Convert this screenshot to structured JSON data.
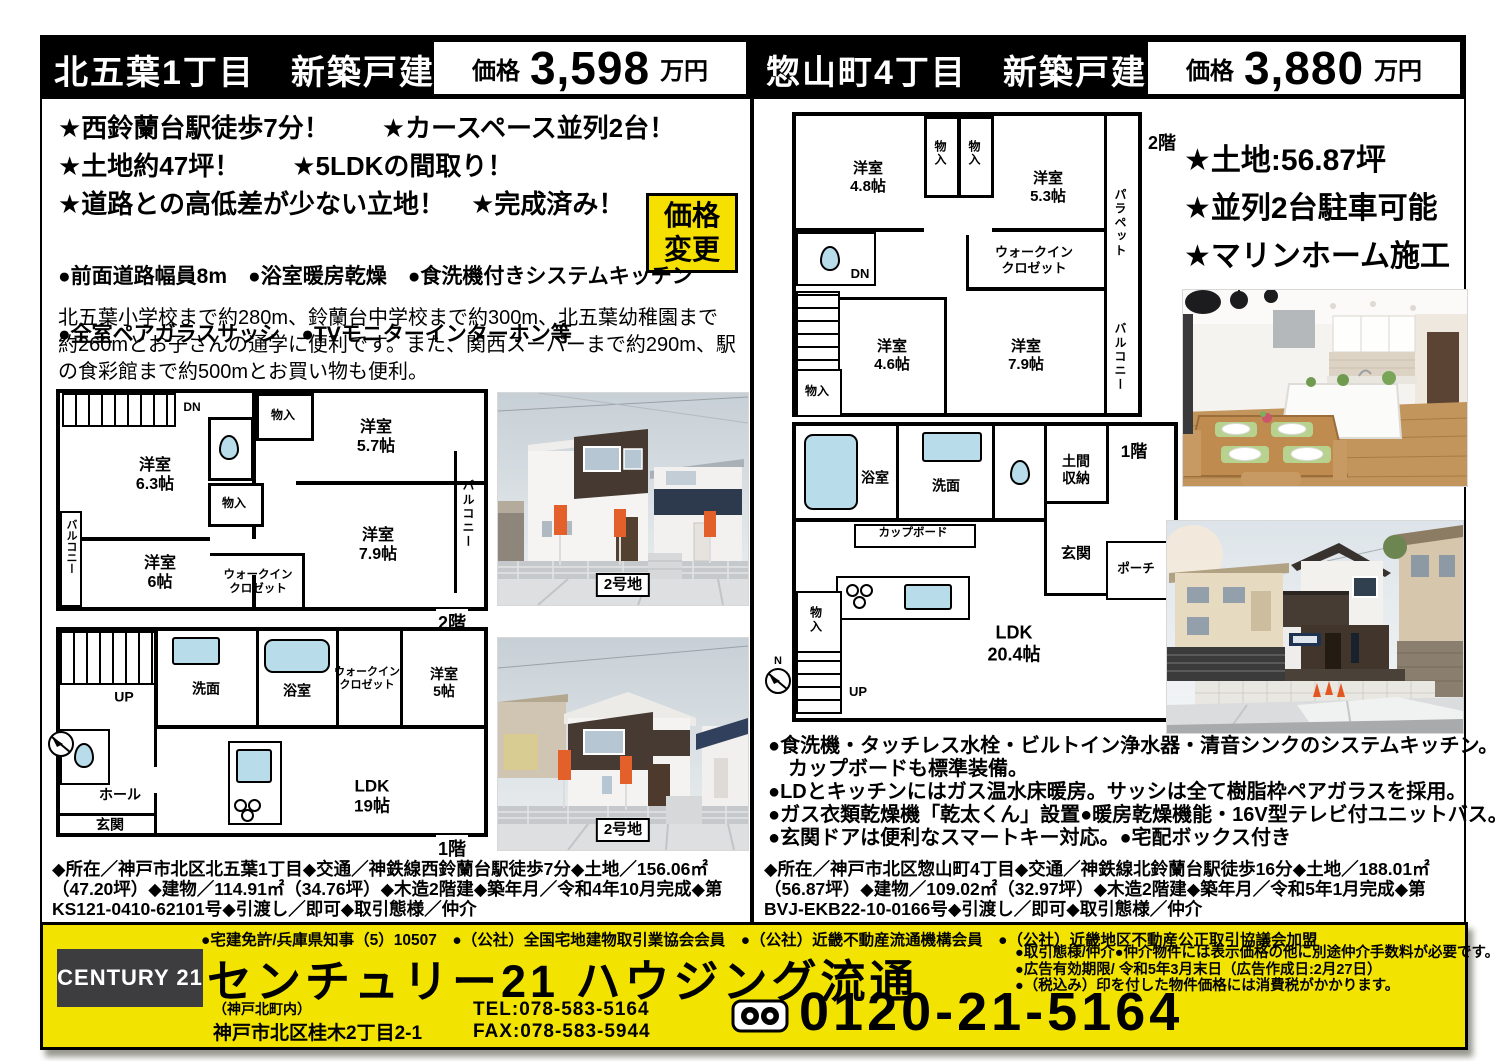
{
  "left": {
    "title": "北五葉1丁目　新築戸建",
    "price": {
      "label": "価格",
      "value": "3,598",
      "unit": "万円"
    },
    "features": [
      "★西鈴蘭台駅徒歩7分！　　★カースペース並列2台！",
      "★土地約47坪！　　★5LDKの間取り！",
      "★道路との高低差が少ない立地！　★完成済み！"
    ],
    "badge": "価格\n変更",
    "equipment": [
      "●前面道路幅員8m　●浴室暖房乾燥　●食洗機付きシステムキッチン",
      "●全室ペアガラスサッシ　●TVモニターインターホン等"
    ],
    "description": "北五葉小学校まで約280m、鈴蘭台中学校まで約300m、北五葉幼稚園まで約260mとお子さんの通学に便利です。また、関西スーパーまで約290m、駅の食彩館まで約500mとお買い物も便利。",
    "floor2": {
      "label": "2階",
      "dn": "DN",
      "room_a": "洋室\n6.3帖",
      "room_b": "洋室\n5.7帖",
      "room_c": "洋室\n6帖",
      "room_d": "洋室\n7.9帖",
      "closet_a": "物入",
      "closet_b": "物入",
      "wic": "ウォークイン\nクロゼット",
      "balcony_left": "バルコニー",
      "balcony_right": "バルコニー"
    },
    "floor1": {
      "label": "1階",
      "up": "UP",
      "washroom": "洗面",
      "bath": "浴室",
      "wic": "ウォークイン\nクロゼット",
      "room": "洋室\n5帖",
      "hall": "ホール",
      "entrance": "玄関",
      "ldk": "LDK\n19帖"
    },
    "photo1_label": "2号地",
    "photo2_label": "2号地",
    "details": "◆所在／神戸市北区北五葉1丁目◆交通／神鉄線西鈴蘭台駅徒歩7分◆土地／156.06㎡（47.20坪）◆建物／114.91㎡（34.76坪）◆木造2階建◆築年月／令和4年10月完成◆第KS121-0410-62101号◆引渡し／即可◆取引態様／仲介"
  },
  "right": {
    "title": "惣山町4丁目　新築戸建",
    "price": {
      "label": "価格",
      "value": "3,880",
      "unit": "万円"
    },
    "features": [
      "★土地:56.87坪",
      "★並列2台駐車可能",
      "★マリンホーム施工"
    ],
    "floor2": {
      "label": "2階",
      "dn": "DN",
      "room_a": "洋室\n4.8帖",
      "room_b": "洋室\n5.3帖",
      "room_c": "洋室\n4.6帖",
      "room_d": "洋室\n7.9帖",
      "closet_a": "物入",
      "closet_b": "物入",
      "closet_c": "物入",
      "wic": "ウォークイン\nクロゼット",
      "parapet": "パラペット",
      "balcony": "バルコニー"
    },
    "floor1": {
      "label": "1階",
      "up": "UP",
      "bath": "浴室",
      "washroom": "洗面",
      "doma": "土間\n収納",
      "cupboard": "カップボード",
      "entrance": "玄関",
      "porch": "ポーチ",
      "closet": "物\n入",
      "ldk": "LDK\n20.4帖",
      "north": "N"
    },
    "bullets": [
      "●食洗機・タッチレス水栓・ビルトイン浄水器・清音シンクのシステムキッチン。",
      "　カップボードも標準装備。",
      "●LDとキッチンにはガス温水床暖房。サッシは全て樹脂枠ペアガラスを採用。",
      "●ガス衣類乾燥機「乾太くん」設置●暖房乾燥機能・16V型テレビ付ユニットバス。",
      "●玄関ドアは便利なスマートキー対応。●宅配ボックス付き"
    ],
    "details": "◆所在／神戸市北区惣山町4丁目◆交通／神鉄線北鈴蘭台駅徒歩16分◆土地／188.01㎡（56.87坪）◆建物／109.02㎡（32.97坪）◆木造2階建◆築年月／令和5年1月完成◆第BVJ-EKB22-10-0166号◆引渡し／即可◆取引態様／仲介"
  },
  "footer": {
    "memberships": "●宅建免許/兵庫県知事（5）10507　●（公社）全国宅地建物取引業協会会員　●（公社）近畿不動産流通機構会員　●（公社）近畿地区不動産公正取引協議会加盟",
    "brand": "CENTURY 21",
    "company": "センチュリー21 ハウジング流通",
    "branch": "（神戸北町内）",
    "address": "神戸市北区桂木2丁目2-1",
    "telfax": "TEL:078-583-5164\nFAX:078-583-5944",
    "notes": [
      "●取引態様/仲介●仲介物件には表示価格の他に別途仲介手数料が必要です。",
      "●広告有効期限/ 令和5年3月末日（広告作成日:2月27日）",
      "●（税込み）印を付した物件価格には消費税がかかります。"
    ],
    "freedial": "0120-21-5164"
  },
  "colors": {
    "accent_yellow": "#f2e400",
    "badge_yellow": "#f6e000",
    "header_black": "#000000",
    "fixture_blue": "#b8dcea",
    "brand_grey": "#3d3d3f"
  }
}
